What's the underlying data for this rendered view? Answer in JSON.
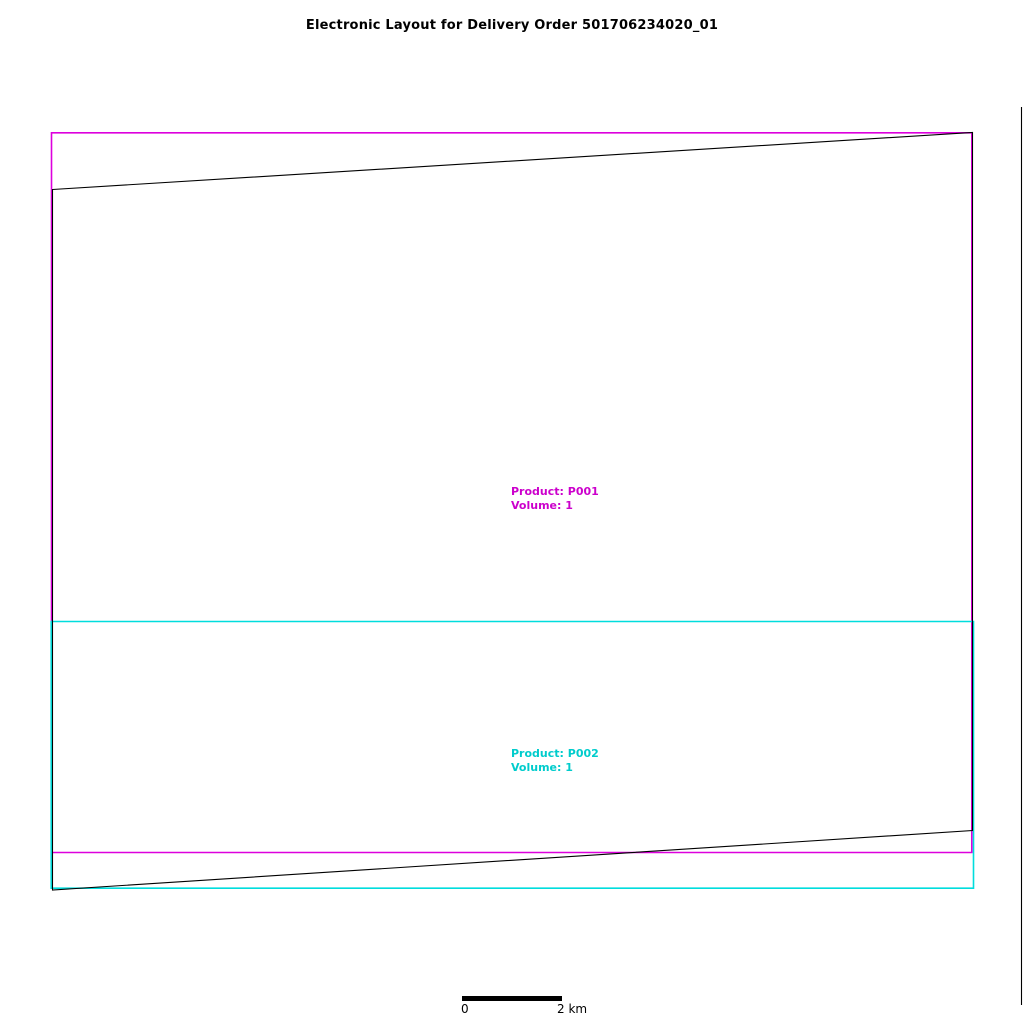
{
  "title": "Electronic Layout for Delivery Order 501706234020_01",
  "colors": {
    "product1-line": "#DD00DD",
    "product1-text": "#CC00CC",
    "product2-line": "#00DDDD",
    "product2-text": "#00CCCC",
    "outline": "#000000",
    "scale-bar": "#000000"
  },
  "products": [
    {
      "lines": [
        "Product: P001",
        "Volume: 1"
      ]
    },
    {
      "lines": [
        "Product: P002",
        "Volume: 1"
      ]
    }
  ],
  "scale_bar": {
    "start_label": "0",
    "end_label": "2 km"
  },
  "shapes": {
    "product1_path": "M51.5 132.8 L971.8 132.8 L971.8 852.5 L51.5 852.5 Z",
    "product2_path": "M51.2 621.5 L973.5 621.5 L973.5 888.2 L51.2 888.2 Z",
    "outline_points": "52.5,189.5 972.5,132.5 972.5,830.5 52.5,890",
    "frame_right_path": "M1021.5 107 L1021.5 1005",
    "scale_bar_path": "M462 996 L562 996 L562 1001 L462 1001 Z"
  }
}
